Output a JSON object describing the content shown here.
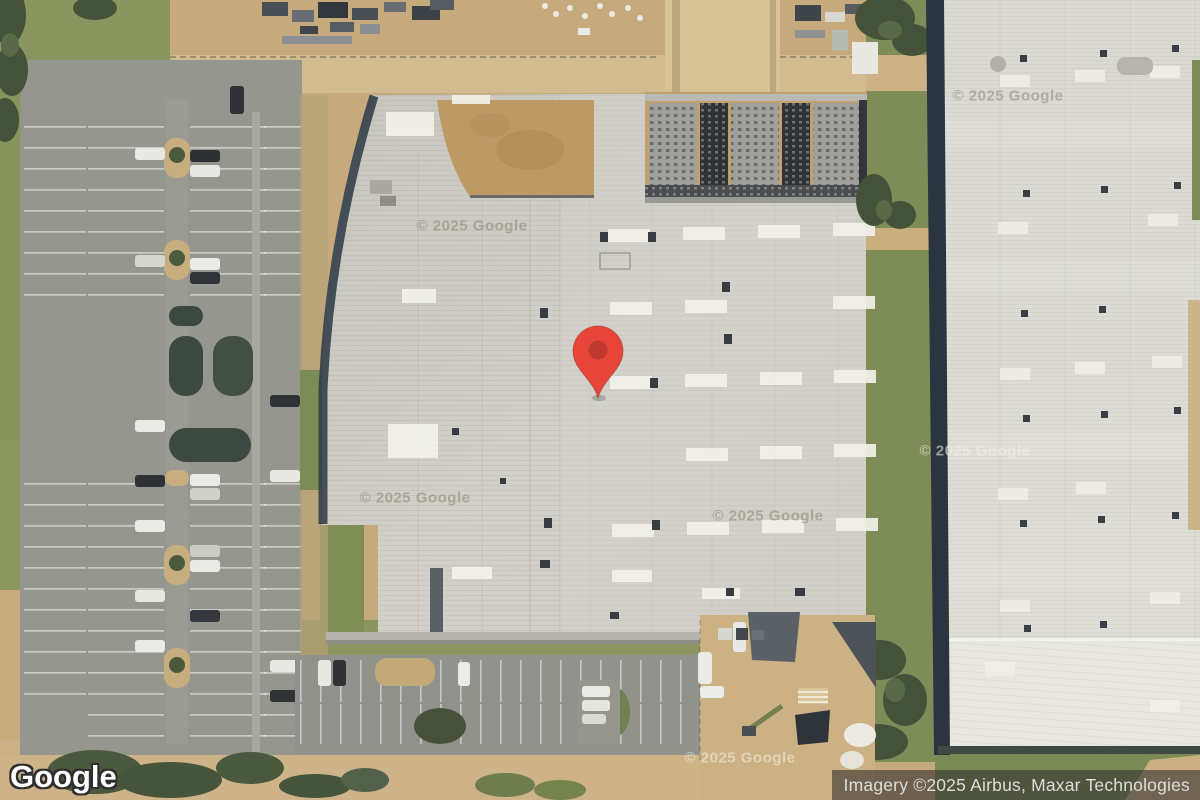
{
  "map": {
    "view_type": "satellite",
    "provider_logo": "Google",
    "attribution": "Imagery ©2025 Airbus, Maxar Technologies",
    "watermark": "© 2025 Google",
    "marker": {
      "name": "location-pin",
      "fill_color": "#E8453A",
      "dot_color": "#BE3A2F"
    },
    "colors": {
      "main_roof": "#CDCCC4",
      "east_roof": "#DEDED6",
      "asphalt": "#95978F",
      "dirt": "#C6A97C",
      "grass": "#7E8C58",
      "tree": "#46543C",
      "building_shadow": "#2B3540",
      "skylight_white": "#F2F2EA",
      "attribution_bg": "rgba(44,44,44,0.58)",
      "attribution_text": "#DEDDDB"
    }
  }
}
